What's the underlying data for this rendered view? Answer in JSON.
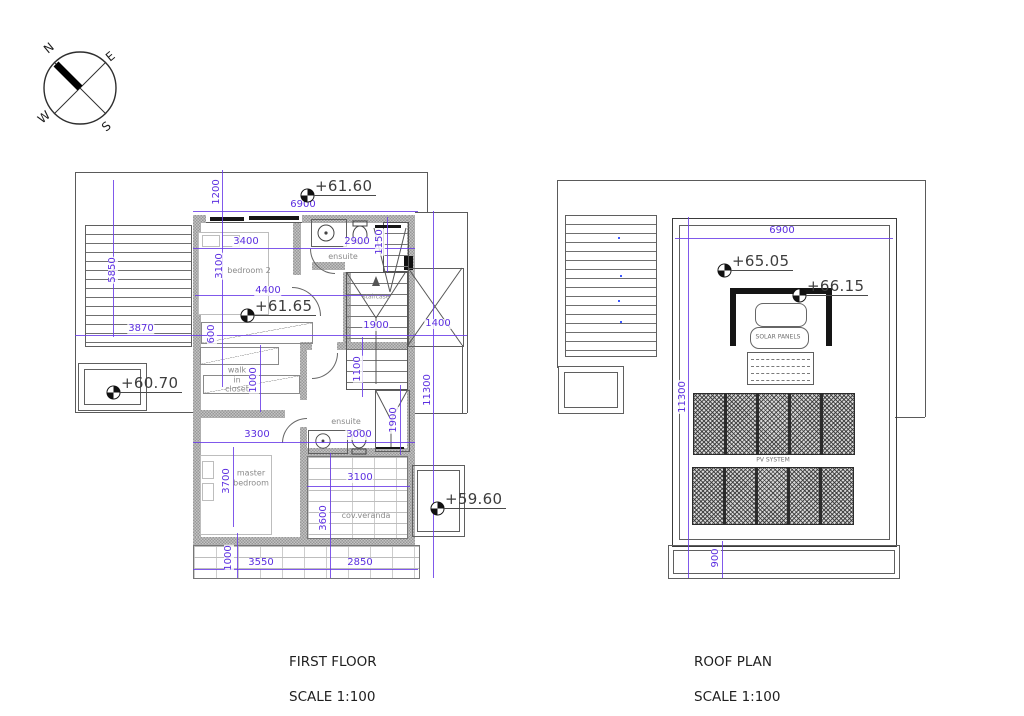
{
  "compass": {
    "n": "N",
    "e": "E",
    "s": "S",
    "w": "W"
  },
  "first_floor": {
    "title": "FIRST FLOOR",
    "scale": "SCALE 1:100",
    "levels": {
      "l1": "+61.60",
      "l2": "+61.65",
      "l3": "+60.70",
      "l4": "+59.60"
    },
    "rooms": {
      "bedroom2": "bedroom 2",
      "ensuite_top": "ensuite",
      "staircase": "staircase",
      "closet": "walk\nin\ncloset",
      "master": "master\nbedroom",
      "ensuite_bottom": "ensuite",
      "veranda": "cov.veranda"
    },
    "dims": {
      "d1200": "1200",
      "d6900": "6900",
      "d3400": "3400",
      "d2900": "2900",
      "d1150": "1150",
      "d3100": "3100",
      "d5850": "5850",
      "d4400": "4400",
      "d3870": "3870",
      "d1900_stair": "1900",
      "d1400": "1400",
      "d600": "600",
      "d1100": "1100",
      "d1000_closet": "1000",
      "d11300": "11300",
      "d1900_shower": "1900",
      "d3300": "3300",
      "d3000": "3000",
      "d3700": "3700",
      "d3100_veranda": "3100",
      "d3600": "3600",
      "d1000_bottom": "1000",
      "d3550": "3550",
      "d2850": "2850"
    }
  },
  "roof_plan": {
    "title": "ROOF PLAN",
    "scale": "SCALE 1:100",
    "levels": {
      "l1": "+65.05",
      "l2": "+66.15"
    },
    "labels": {
      "solar": "SOLAR PANELS",
      "pv": "PV SYSTEM"
    },
    "dims": {
      "d6900": "6900",
      "d11300": "11300",
      "d900": "900"
    }
  },
  "colors": {
    "dimension": "#5b2ee0",
    "wall": "#b2b2b2",
    "line": "#5a5a5a",
    "room_label": "#8a8a8a",
    "level_text": "#3d3d3d"
  }
}
